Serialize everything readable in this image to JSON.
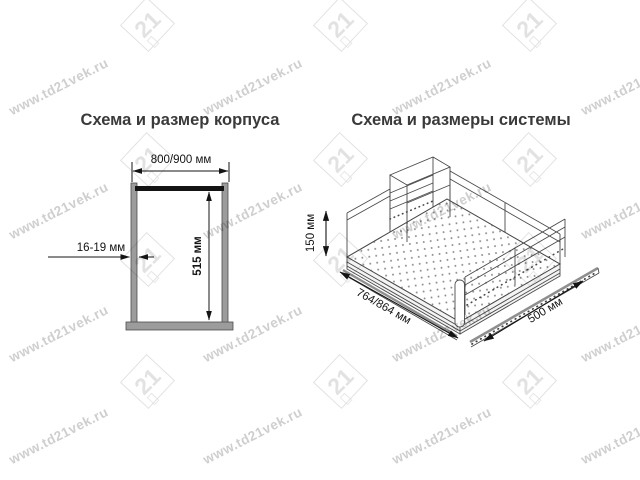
{
  "watermark": {
    "text": "www.td21vek.ru",
    "logo": "21",
    "text_color": "#cfcfcf",
    "logo_color": "#e2e2e2"
  },
  "left_diagram": {
    "title": "Схема и размер корпуса",
    "width_label": "800/900 мм",
    "thickness_label": "16-19 мм",
    "height_label": "515 мм"
  },
  "right_diagram": {
    "title": "Схема и размеры системы",
    "height_label": "150 мм",
    "length_label": "764/864 мм",
    "depth_label": "500 мм"
  },
  "colors": {
    "title_text": "#3a3a3a",
    "dimension_text": "#141414",
    "dimension_line": "#141414",
    "cabinet_panel_gray": "#9c9c9c",
    "cabinet_panel_edge": "#4d4d4d",
    "cabinet_top_bar": "#141414",
    "drawing_line": "#4a4a4a",
    "watermark_text": "#cfcfcf",
    "watermark_logo": "#e2e2e2",
    "background": "#ffffff"
  }
}
